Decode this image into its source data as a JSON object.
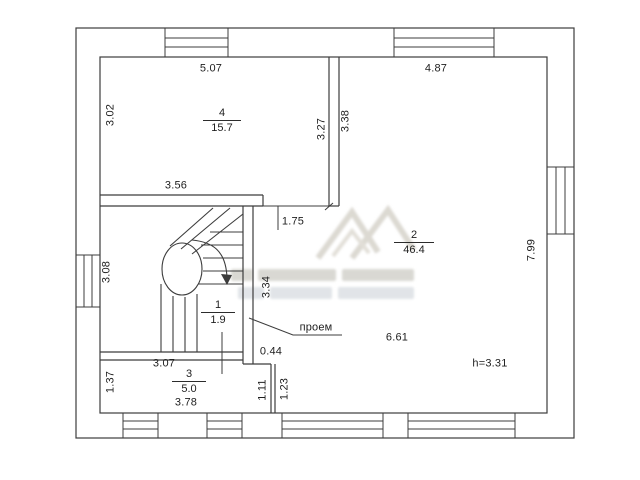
{
  "plan": {
    "background": "#ffffff",
    "line_color": "#3c3c3c",
    "rooms": {
      "r1": {
        "number": "1",
        "area": "1.9"
      },
      "r2": {
        "number": "2",
        "area": "46.4"
      },
      "r3": {
        "number": "3",
        "area": "5.0"
      },
      "r4": {
        "number": "4",
        "area": "15.7"
      }
    },
    "dims": {
      "room4_top": "5.07",
      "room2_top": "4.87",
      "room4_left": "3.02",
      "room4_right": "3.27",
      "room2_left_upper": "3.38",
      "room4_bottom": "3.56",
      "hall_opening": "1.75",
      "stair_left": "3.08",
      "stair_right": "3.34",
      "room3_top": "3.07",
      "step_offset": "0.44",
      "room3_left": "1.37",
      "room3_bottom": "3.78",
      "niche_left": "1.11",
      "niche_right": "1.23",
      "room2_lower_width": "6.61",
      "room2_right": "7.99"
    },
    "notes": {
      "opening": "проем",
      "ceiling_height": "h=3.31"
    }
  }
}
